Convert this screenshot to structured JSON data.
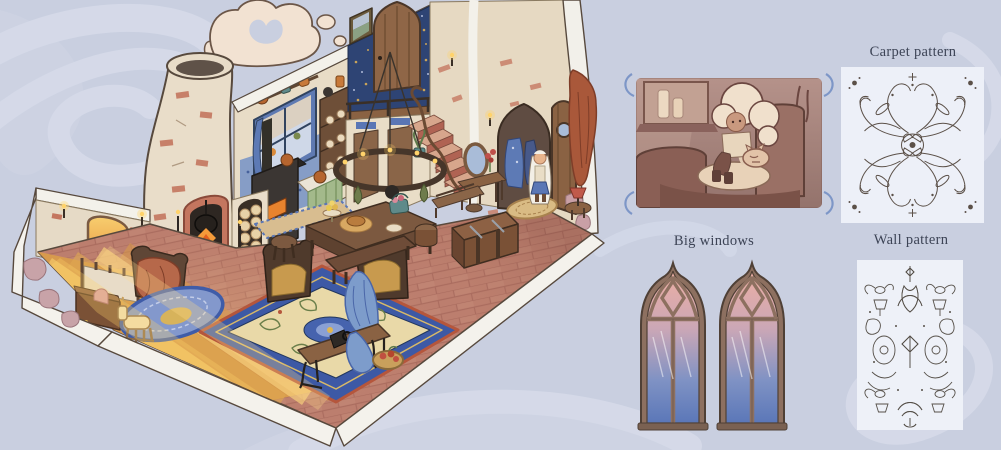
{
  "page": {
    "background_color": "#c9cfe0",
    "swirl_color": "#d6dbe9"
  },
  "panels": {
    "carpet": {
      "label": "Carpet pattern"
    },
    "windows": {
      "label": "Big windows"
    },
    "wall": {
      "label": "Wall pattern"
    }
  },
  "illustration": {
    "subject": "isometric cutaway cottage interior with chimney, fireplace, kitchen, stairs and characters",
    "accent_colors": {
      "wall_cream": "#e8dcc6",
      "brick_floor": "#bc7e6e",
      "wallpaper_blue": "#2e4474",
      "carpet_border_blue": "#3d59a5",
      "carpet_field_cream": "#e9d9a8",
      "wood_brown": "#7a5a40",
      "flame_orange": "#e8832e",
      "window_glass_top": "#ecaea3",
      "window_glass_bottom": "#5b77b8",
      "sepia_panel": "#a98680"
    }
  }
}
